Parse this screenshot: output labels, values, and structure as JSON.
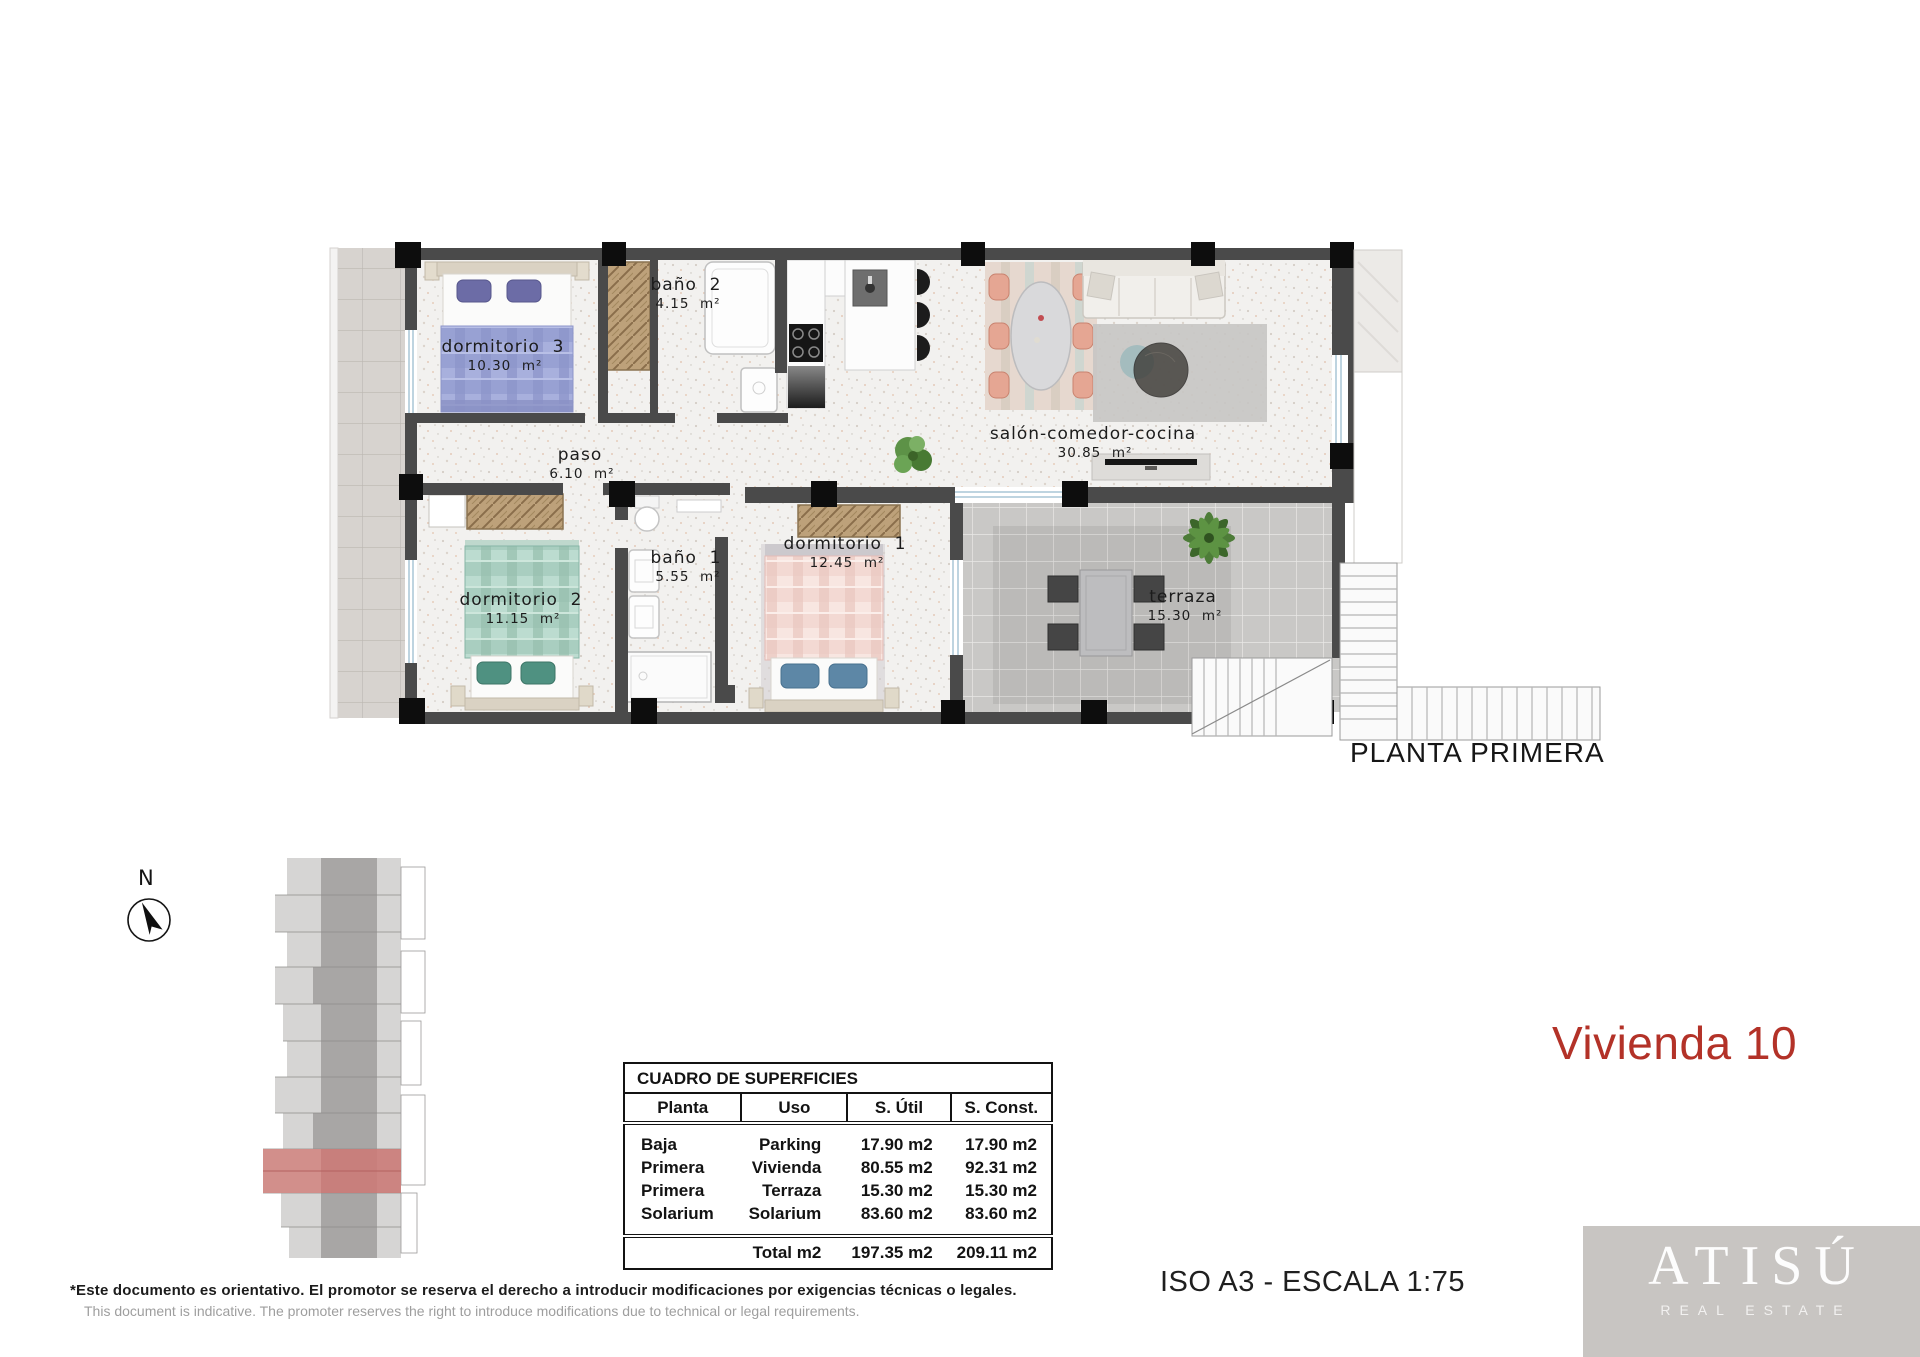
{
  "plan": {
    "caption": "PLANTA PRIMERA",
    "rooms": [
      {
        "name": "dormitorio  3",
        "area": "10.30  m²"
      },
      {
        "name": "baño  2",
        "area": "4.15  m²"
      },
      {
        "name": "paso",
        "area": "6.10  m²"
      },
      {
        "name": "salón-comedor-cocina",
        "area": "30.85  m²"
      },
      {
        "name": "dormitorio  2",
        "area": "11.15  m²"
      },
      {
        "name": "baño  1",
        "area": "5.55  m²"
      },
      {
        "name": "dormitorio  1",
        "area": "12.45  m²"
      },
      {
        "name": "terraza",
        "area": "15.30  m²"
      }
    ]
  },
  "compass": {
    "label": "N"
  },
  "surfaces_table": {
    "title": "CUADRO DE SUPERFICIES",
    "headers": [
      "Planta",
      "Uso",
      "S. Útil",
      "S. Const."
    ],
    "rows": [
      [
        "Baja",
        "Parking",
        "17.90 m2",
        "17.90 m2"
      ],
      [
        "Primera",
        "Vivienda",
        "80.55 m2",
        "92.31 m2"
      ],
      [
        "Primera",
        "Terraza",
        "15.30 m2",
        "15.30 m2"
      ],
      [
        "Solarium",
        "Solarium",
        "83.60 m2",
        "83.60 m2"
      ]
    ],
    "total": {
      "label": "Total m2",
      "util": "197.35 m2",
      "const": "209.11 m2"
    }
  },
  "unit_title": "Vivienda 10",
  "scale_note": "ISO A3 - ESCALA 1:75",
  "disclaimer": {
    "es": "*Este documento es orientativo. El promotor se reserva el derecho a introducir modificaciones por exigencias técnicas o legales.",
    "en": "This document is indicative. The promoter reserves the right to introduce modifications due to technical or legal requirements."
  },
  "logo": {
    "name": "ATISÚ",
    "tagline": "REAL ESTATE"
  },
  "colors": {
    "accent_red": "#b33228",
    "highlight_red": "#cb7b78",
    "wall": "#4a4a4a",
    "logo_bg": "#c8c5c2"
  }
}
